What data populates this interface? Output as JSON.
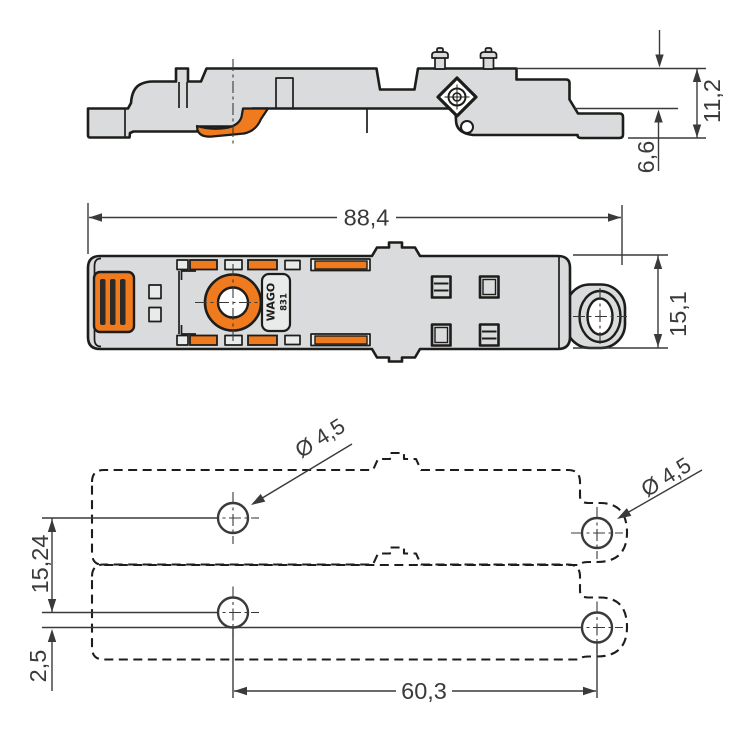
{
  "colors": {
    "background": "#ffffff",
    "line_dark": "#1d1d1b",
    "dim_color": "#3a3a3a",
    "body_gray": "#d9dbdc",
    "light_gray": "#e9eaea",
    "accent_orange": "#EF7B1E",
    "slot_dark": "#2e2a26",
    "white": "#ffffff"
  },
  "views": {
    "side_view": {
      "dim_total_height": "11,2",
      "dim_lower_height": "6,6"
    },
    "top_view": {
      "dim_length": "88,4",
      "dim_width": "15,1",
      "logo": "WAGO",
      "series": "831"
    },
    "drilling_plan": {
      "dim_vertical_pitch": "15,24",
      "dim_offset": "2,5",
      "dim_horizontal_pitch": "60,3",
      "hole_label_left": "Ø 4,5",
      "hole_label_right": "Ø 4,5"
    }
  }
}
